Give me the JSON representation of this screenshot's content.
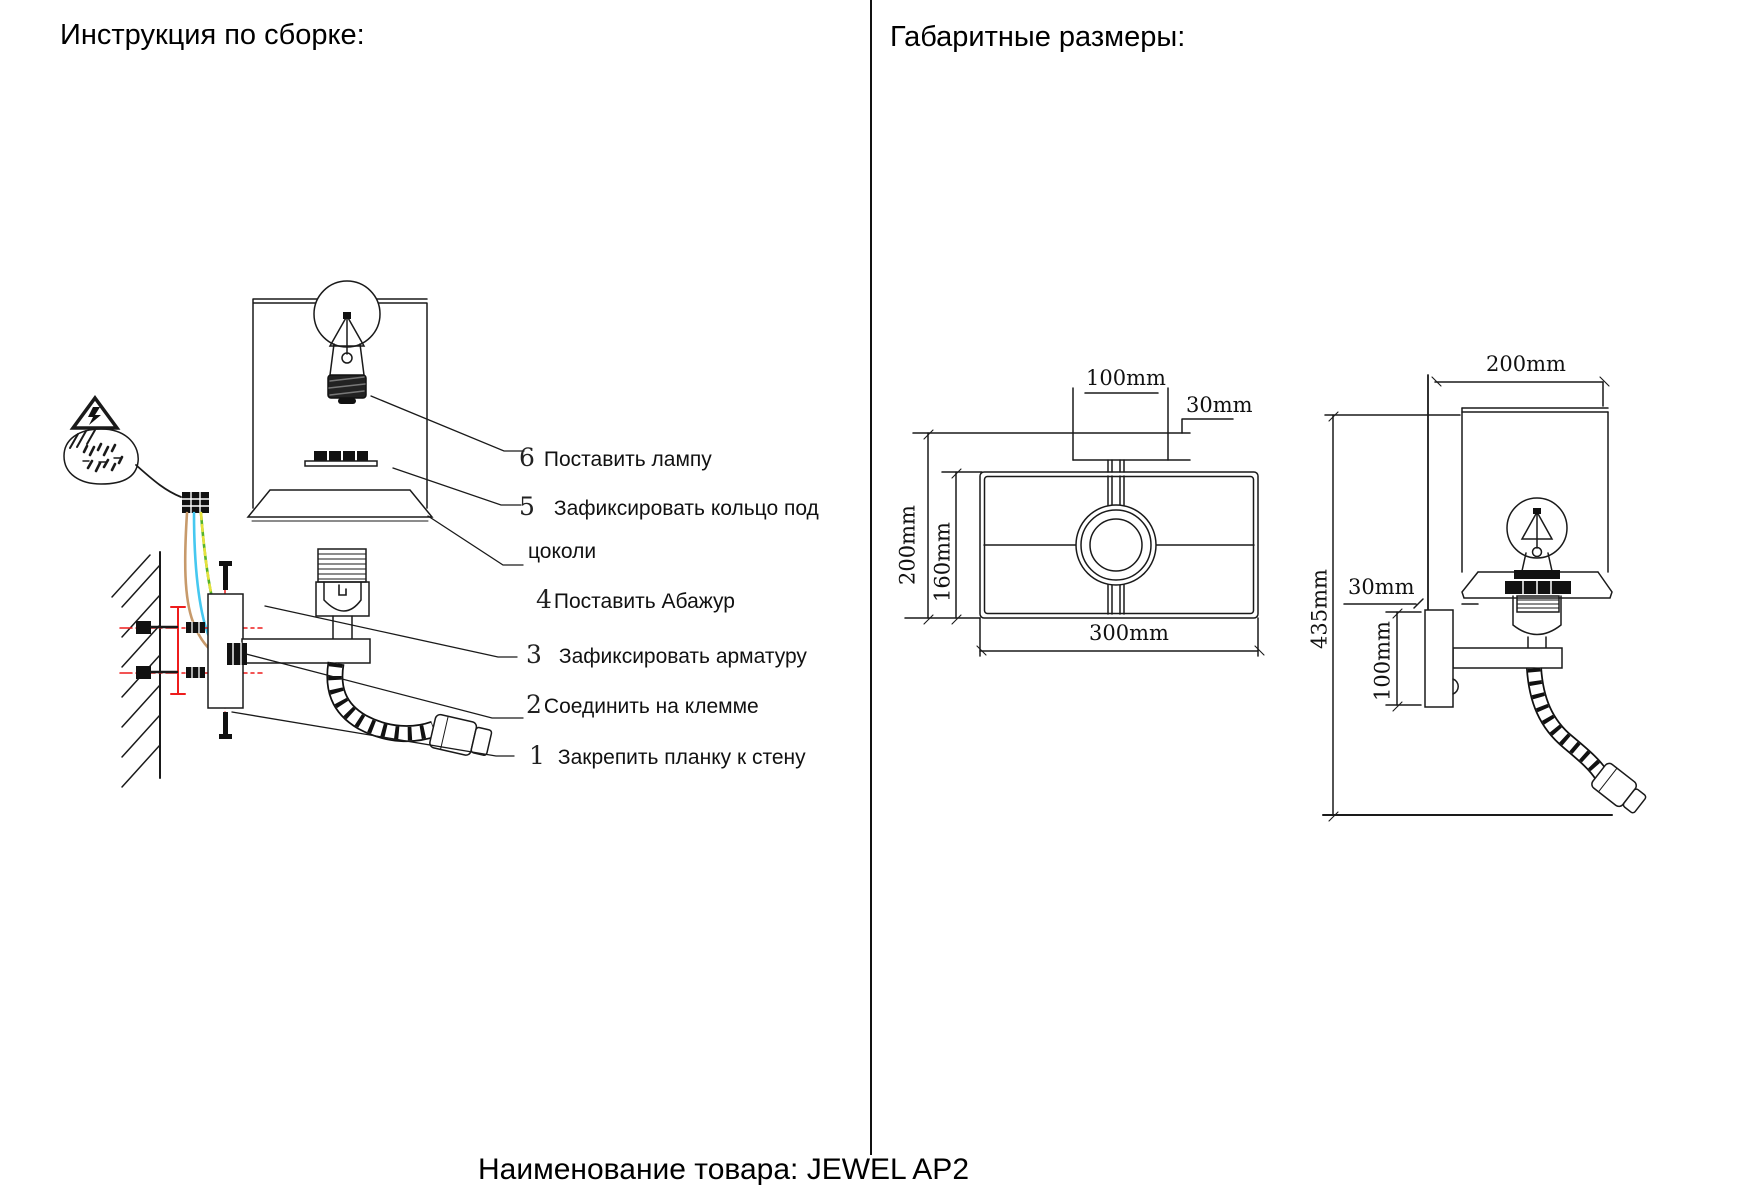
{
  "titles": {
    "left": "Инструкция по сборке:",
    "right": "Габаритные размеры:"
  },
  "steps": [
    {
      "num": "6",
      "text": "Поставить лампу"
    },
    {
      "num": "5",
      "text": "Зафиксировать кольцо под",
      "text2": "цоколи"
    },
    {
      "num": "4",
      "text": "Поставить Абажур"
    },
    {
      "num": "3",
      "text": "Зафиксировать арматуру"
    },
    {
      "num": "2",
      "text": "Соединить на клемме"
    },
    {
      "num": "1",
      "text": "Закрепить планку к стену"
    }
  ],
  "dims": {
    "front": {
      "width_top": "100mm",
      "plate_height": "30mm",
      "height_total": "200mm",
      "shade_height": "160mm",
      "width_total": "300mm"
    },
    "side": {
      "depth_total": "200mm",
      "height_total": "435mm",
      "plate_depth": "30mm",
      "plate_height": "100mm"
    }
  },
  "footer": {
    "product_caption": "Наименование товара: JEWEL AP2"
  },
  "icons": {
    "warning": "high-voltage-warning-triangle",
    "detail_balloon": "wiring-detail-callout"
  },
  "colors": {
    "line": "#1a1a1a",
    "wire_brown": "#c79a6b",
    "wire_blue": "#45c8f0",
    "wire_green": "#54b32a",
    "wire_yellow": "#e6e23c",
    "hardware_red": "#ee1c1c"
  }
}
